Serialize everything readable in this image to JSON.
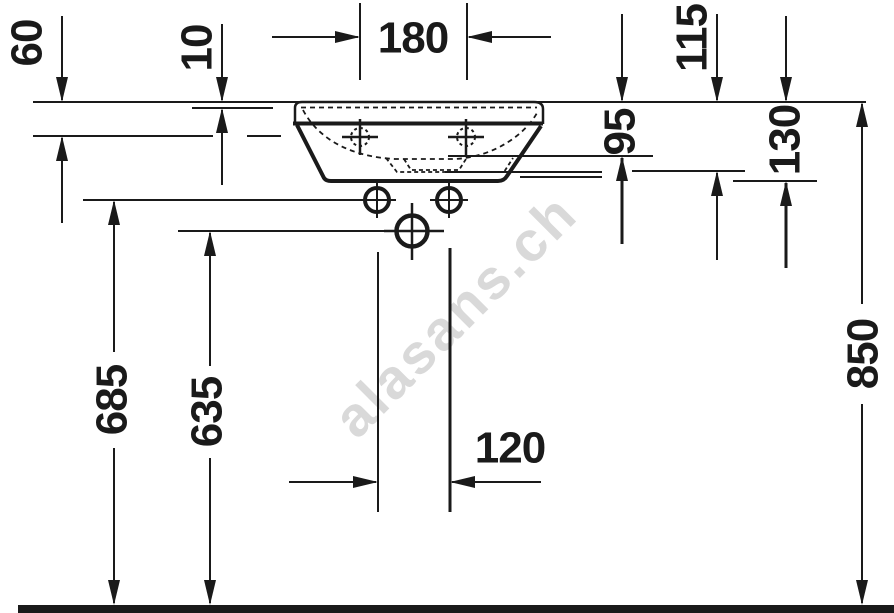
{
  "drawing": {
    "type": "technical-dimension-drawing",
    "subject": "wall-mounted handrinse washbasin, front elevation with installation dimensions",
    "units": "mm",
    "colors": {
      "line": "#1a1a1a",
      "background": "#ffffff",
      "watermark": "#d9d9d9"
    },
    "dims": {
      "d60": "60",
      "d10": "10",
      "d180": "180",
      "d115": "115",
      "d95": "95",
      "d130": "130",
      "d685": "685",
      "d635": "635",
      "d120": "120",
      "d850": "850"
    },
    "watermark": {
      "text": "alasans.ch"
    }
  }
}
